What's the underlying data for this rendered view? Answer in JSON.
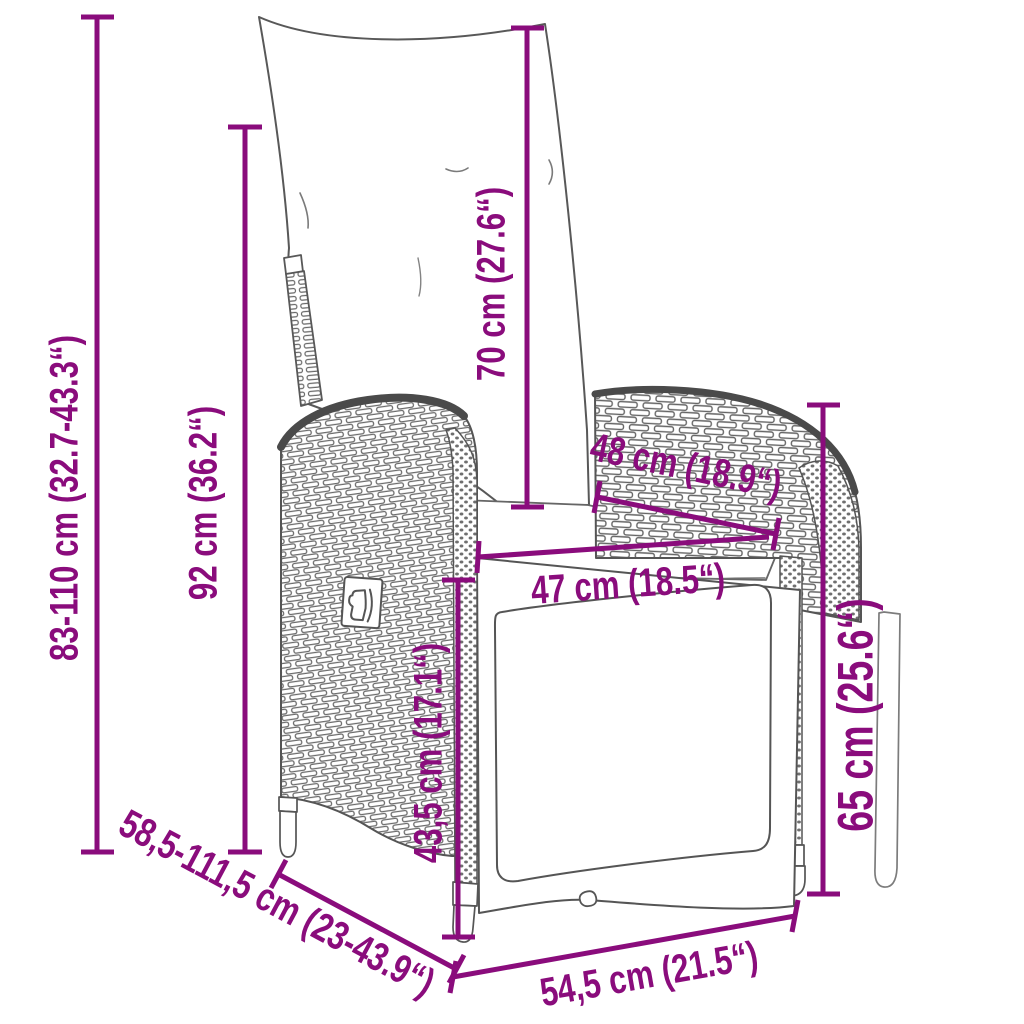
{
  "diagram": {
    "figure": "reclining-garden-chair-line-drawing",
    "accent_color": "#8a0c7c",
    "outline_color": "#4f4f4f",
    "weave_color": "#6a6a6a",
    "dimensions": [
      {
        "name": "overall-height",
        "label": "83-110 cm (32.7-43.3“)",
        "value_cm": "83-110",
        "value_in": "32.7-43.3"
      },
      {
        "name": "backrest-height",
        "label": "92 cm (36.2“)",
        "value_cm": "92",
        "value_in": "36.2"
      },
      {
        "name": "back-cushion-height",
        "label": "70 cm (27.6“)",
        "value_cm": "70",
        "value_in": "27.6"
      },
      {
        "name": "seat-depth",
        "label": "48 cm (18.9“)",
        "value_cm": "48",
        "value_in": "18.9"
      },
      {
        "name": "seat-width",
        "label": "47 cm (18.5“)",
        "value_cm": "47",
        "value_in": "18.5"
      },
      {
        "name": "seat-height",
        "label": "43,5 cm (17.1“)",
        "value_cm": "43,5",
        "value_in": "17.1"
      },
      {
        "name": "armrest-height",
        "label": "65 cm (25.6“)",
        "value_cm": "65",
        "value_in": "25.6"
      },
      {
        "name": "extended-depth",
        "label": "58,5-111,5 cm (23-43.9“)",
        "value_cm": "58,5-111,5",
        "value_in": "23-43.9"
      },
      {
        "name": "base-width",
        "label": "54,5 cm (21.5“)",
        "value_cm": "54,5",
        "value_in": "21.5"
      }
    ]
  }
}
